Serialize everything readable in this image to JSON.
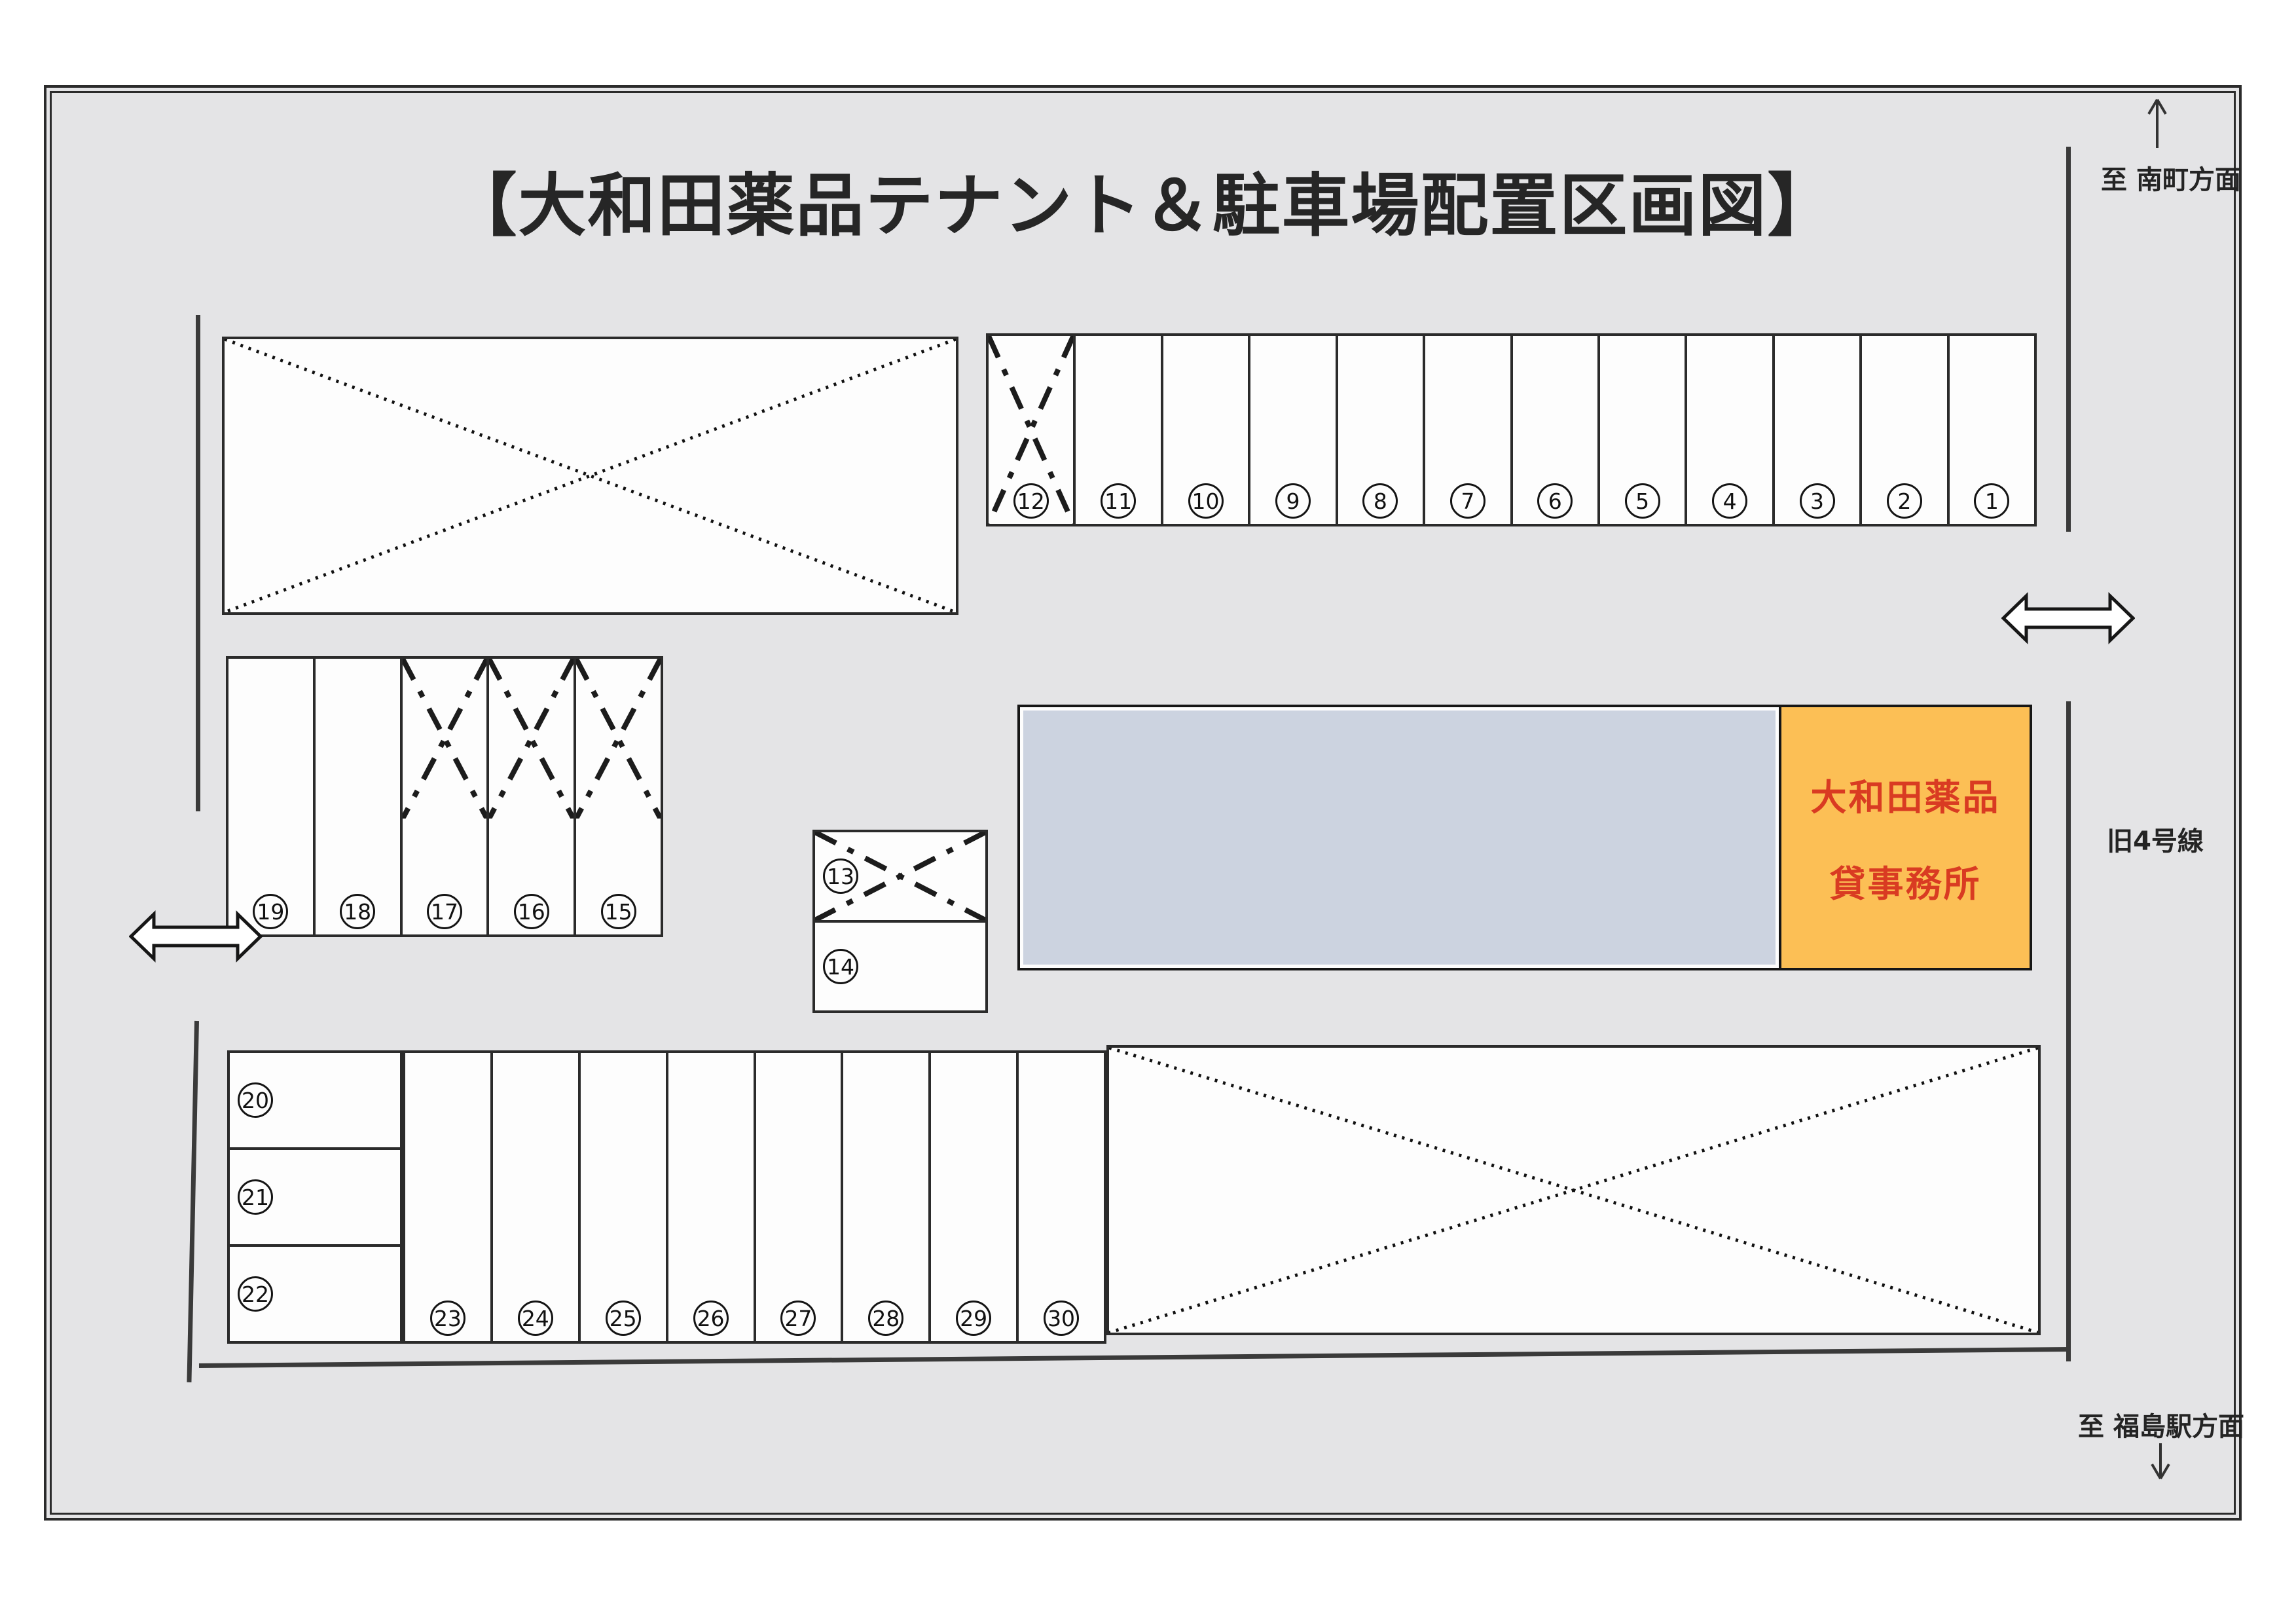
{
  "title": "【大和田薬品テナント＆駐車場配置区画図】",
  "directions": {
    "top_right": {
      "label": "至 南町方面",
      "arrow": "up"
    },
    "bottom_right": {
      "label": "至 福島駅方面",
      "arrow": "down"
    }
  },
  "road": {
    "label": "旧4号線"
  },
  "office": {
    "line1": "大和田薬品",
    "line2": "貸事務所",
    "text_color": "#d93b22",
    "bg_color": "#fcbf55"
  },
  "building": {
    "bg_color": "#ccd3e0"
  },
  "colors": {
    "diagram_bg": "#e4e4e6",
    "line": "#2b2b2b",
    "stall_fill": "#fdfdfd"
  },
  "stalls": {
    "top_row": [
      {
        "no": 12,
        "crossed": true
      },
      {
        "no": 11,
        "crossed": false
      },
      {
        "no": 10,
        "crossed": false
      },
      {
        "no": 9,
        "crossed": false
      },
      {
        "no": 8,
        "crossed": false
      },
      {
        "no": 7,
        "crossed": false
      },
      {
        "no": 6,
        "crossed": false
      },
      {
        "no": 5,
        "crossed": false
      },
      {
        "no": 4,
        "crossed": false
      },
      {
        "no": 3,
        "crossed": false
      },
      {
        "no": 2,
        "crossed": false
      },
      {
        "no": 1,
        "crossed": false
      }
    ],
    "middle_row": [
      {
        "no": 19,
        "crossed": false
      },
      {
        "no": 18,
        "crossed": false
      },
      {
        "no": 17,
        "crossed": true
      },
      {
        "no": 16,
        "crossed": true
      },
      {
        "no": 15,
        "crossed": true
      }
    ],
    "pair_block": [
      {
        "no": 13,
        "crossed": true
      },
      {
        "no": 14,
        "crossed": false
      }
    ],
    "left_stack": [
      {
        "no": 20,
        "crossed": false
      },
      {
        "no": 21,
        "crossed": false
      },
      {
        "no": 22,
        "crossed": false
      }
    ],
    "bottom_row": [
      {
        "no": 23,
        "crossed": false
      },
      {
        "no": 24,
        "crossed": false
      },
      {
        "no": 25,
        "crossed": false
      },
      {
        "no": 26,
        "crossed": false
      },
      {
        "no": 27,
        "crossed": false
      },
      {
        "no": 28,
        "crossed": false
      },
      {
        "no": 29,
        "crossed": false
      },
      {
        "no": 30,
        "crossed": false
      }
    ]
  },
  "blocked_areas": [
    {
      "name": "top-left-lot",
      "style": "dotted-x"
    },
    {
      "name": "bottom-right-lot",
      "style": "dotted-x"
    }
  ]
}
